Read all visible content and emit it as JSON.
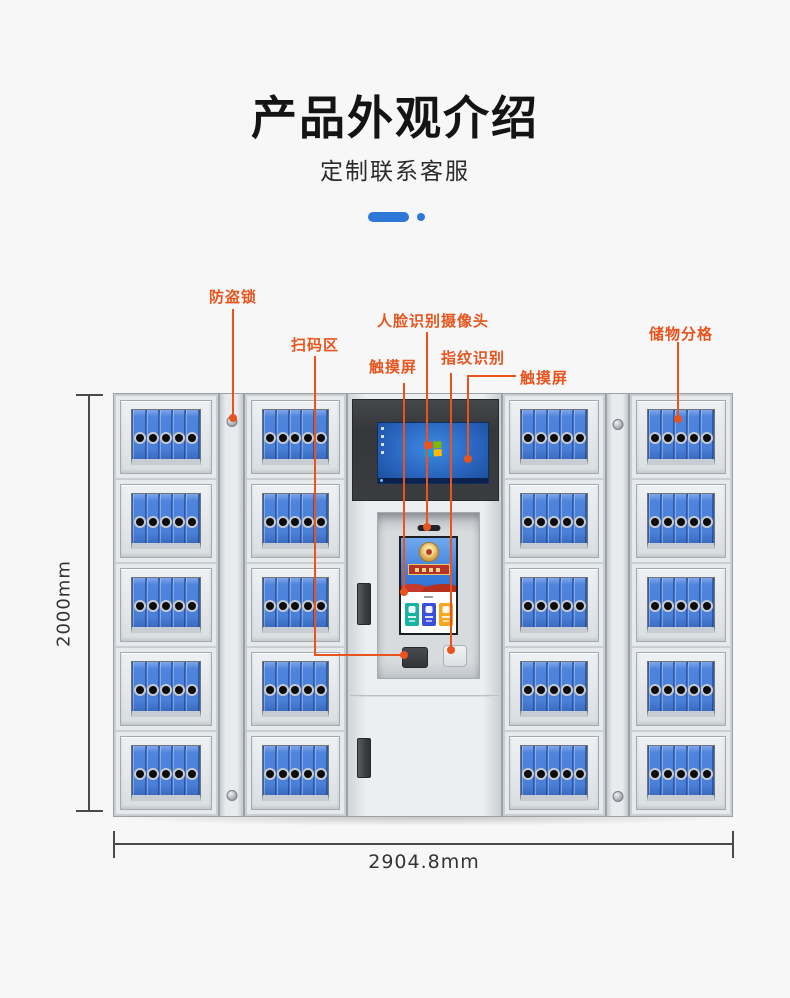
{
  "header": {
    "title": "产品外观介绍",
    "subtitle": "定制联系客服",
    "accent_color": "#2e79d8"
  },
  "callouts": {
    "color": "#e7541e",
    "anti_theft_lock": "防盗锁",
    "scan_area": "扫码区",
    "face_camera": "人脸识别摄像头",
    "touchscreen_left": "触摸屏",
    "fingerprint": "指纹识别",
    "touchscreen_right": "触摸屏",
    "storage_compartment": "储物分格"
  },
  "dimensions": {
    "height": "2000mm",
    "width": "2904.8mm"
  },
  "cabinet": {
    "rows": 5,
    "door_columns": 4,
    "binders_per_compartment": 5,
    "binder_color": "#4b80d8",
    "kiosk_buttons": [
      {
        "name": "kiosk-app-deposit-icon",
        "color": "#17b3a3"
      },
      {
        "name": "kiosk-app-retrieve-icon",
        "color": "#3b50d8"
      },
      {
        "name": "kiosk-app-admin-icon",
        "color": "#f7a722"
      }
    ]
  }
}
